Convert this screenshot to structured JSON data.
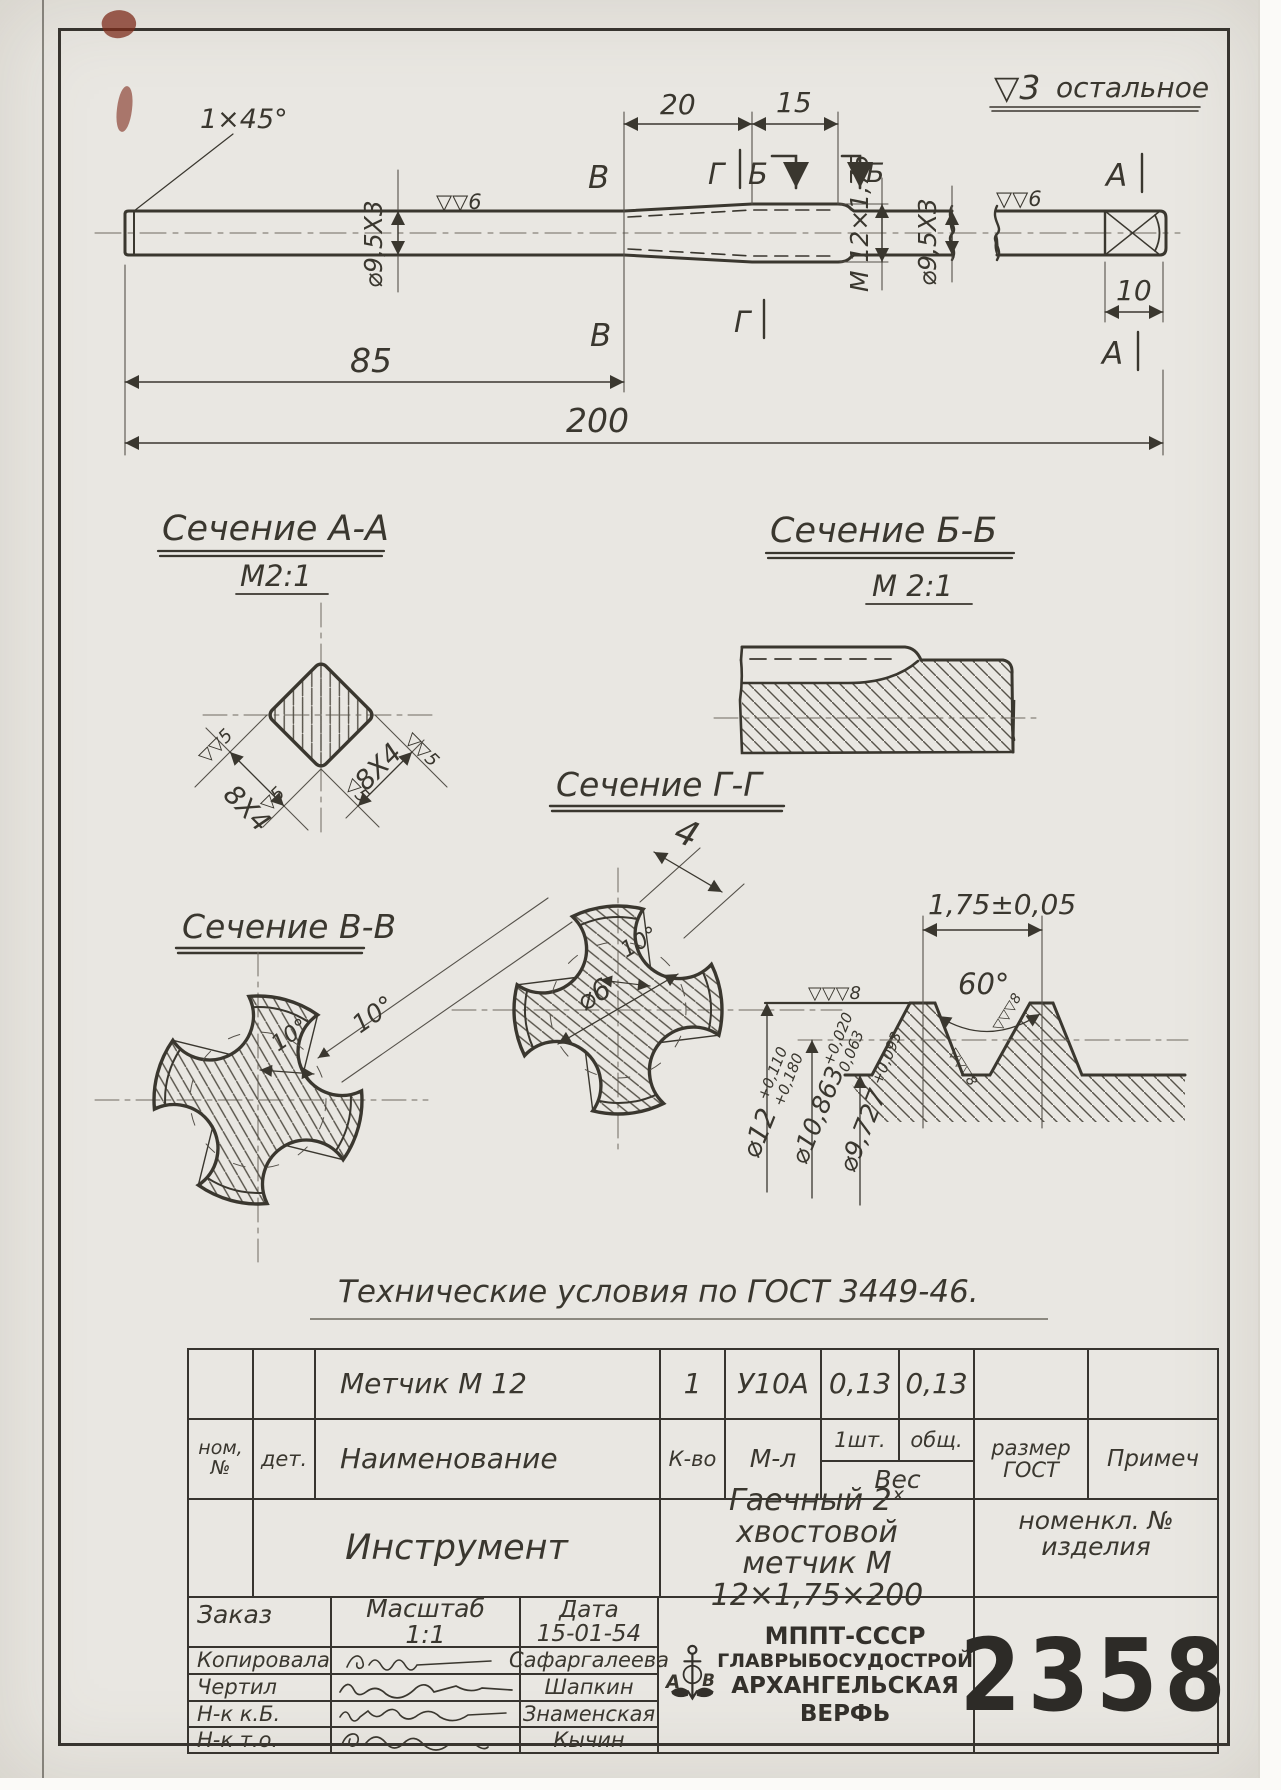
{
  "colors": {
    "paper": "#e9e7e2",
    "ink": "#3a372f",
    "red_mark": "#7e2c1c"
  },
  "notes": {
    "finish_all_mark": "▽3",
    "finish_all_word": "остальное",
    "tech": "Технические условия  по ГОСТ 3449-46."
  },
  "top_view": {
    "chamfer": "1×45°",
    "shank_dia": "⌀9,5Х3",
    "finish6": "▽▽6",
    "d20": "20",
    "d15": "15",
    "d85": "85",
    "d200": "200",
    "d10": "10",
    "thread": "М 12×1,75",
    "sec": {
      "v": "В",
      "g": "Г",
      "b": "Б",
      "a": "А"
    }
  },
  "sections": {
    "a": {
      "title": "Сечение А-А",
      "scale": "М2:1",
      "dim": "8Х4",
      "mark_double": "▽▽5",
      "mark_single": "▽5"
    },
    "b": {
      "title": "Сечение Б-Б",
      "scale": "М 2:1"
    },
    "v": {
      "title": "Сечение В-В",
      "angle": "10°"
    },
    "g": {
      "title": "Сечение Г-Г",
      "width": "4",
      "core": "⌀6",
      "angle": "10°"
    },
    "thread": {
      "pitch": "1,75±0,05",
      "angle": "60°",
      "finish8": "▽▽▽8",
      "d_major": "⌀12",
      "d_major_tol_hi": "+0,110",
      "d_major_tol_lo": "+0,180",
      "d_pitch": "⌀10,863",
      "d_pitch_tol_hi": "+0,020",
      "d_pitch_tol_lo": "0,063",
      "d_minor": "⌀9,727",
      "d_minor_tol": "+0,093"
    }
  },
  "table": {
    "row1": {
      "name": "Метчик  М 12",
      "qty": "1",
      "mat": "У10А",
      "w1": "0,13",
      "w2": "0,13"
    },
    "header": {
      "nom1": "ном,",
      "nom2": "№",
      "det": "дет.",
      "name": "Наименование",
      "qty": "К-во",
      "mat": "М-л",
      "one": "1шт.",
      "total": "общ.",
      "weight": "Вес",
      "size1": "размер",
      "size2": "ГОСТ",
      "note": "Примеч"
    },
    "row3": {
      "group": "Инструмент",
      "desc1": "Гаечный 2ˣ хвостовой",
      "desc2": "метчик  М 12×1,75×200",
      "right1": "номенкл. №",
      "right2": "изделия"
    },
    "bottom": {
      "order": "Заказ",
      "scale_label": "Масштаб",
      "scale_value": "1:1",
      "date_label": "Дата",
      "date_value": "15-01-54",
      "rows": [
        {
          "role": "Копировала",
          "name": "Сафаргалеева"
        },
        {
          "role": "Чертил",
          "name": "Шапкин"
        },
        {
          "role": "Н-к к.Б.",
          "name": "Знаменская"
        },
        {
          "role": "Н-к т.о.",
          "name": "Кычин"
        }
      ],
      "org_lines": [
        "МППТ-СССР",
        "ГЛАВРЫБОСУДОСТРОЙ",
        "АРХАНГЕЛЬСКАЯ",
        "ВЕРФЬ"
      ],
      "logo_left": "А",
      "logo_right": "В",
      "drawing_number": "2358"
    }
  }
}
